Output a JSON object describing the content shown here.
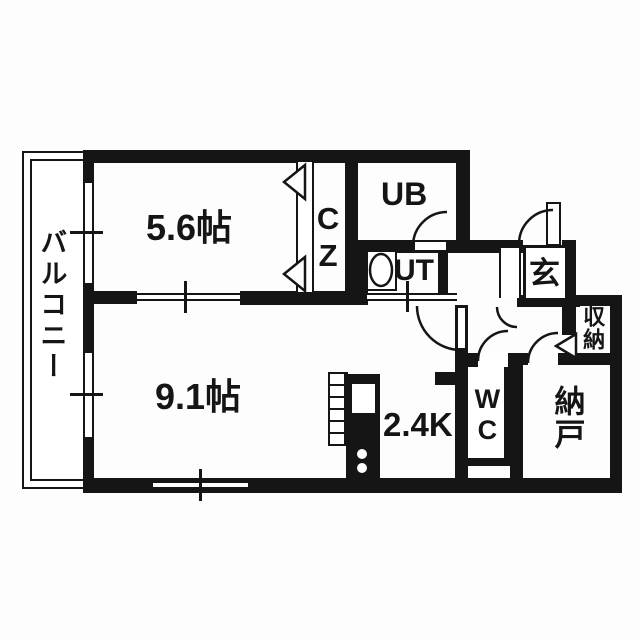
{
  "plan": {
    "title": "apartment floor plan",
    "labels": {
      "balcony": "バルコニー",
      "bedroom": "5.6帖",
      "closet": "CZ",
      "bath": "UB",
      "utility": "UT",
      "entrance": "玄",
      "storage_upper": "収納",
      "living": "9.1帖",
      "kitchen": "2.4K",
      "toilet": "WC",
      "storage_room": "納戸"
    },
    "rooms": [
      {
        "id": "balcony",
        "label": "バルコニー",
        "orientation": "vertical"
      },
      {
        "id": "bedroom",
        "label": "5.6帖",
        "size_jo": 5.6
      },
      {
        "id": "closet",
        "label": "CZ",
        "orientation": "vertical"
      },
      {
        "id": "unit-bath",
        "label": "UB"
      },
      {
        "id": "utility",
        "label": "UT"
      },
      {
        "id": "entrance",
        "label": "玄"
      },
      {
        "id": "storage-upper",
        "label": "収納",
        "orientation": "vertical"
      },
      {
        "id": "living",
        "label": "9.1帖",
        "size_jo": 9.1
      },
      {
        "id": "kitchen",
        "label": "2.4K",
        "size_jo": 2.4
      },
      {
        "id": "toilet",
        "label": "WC",
        "orientation": "vertical"
      },
      {
        "id": "storage-room",
        "label": "納戸",
        "orientation": "vertical"
      }
    ],
    "colors": {
      "wall": "#151515",
      "floor": "#ffffff",
      "background": "#fdfdfd"
    }
  }
}
